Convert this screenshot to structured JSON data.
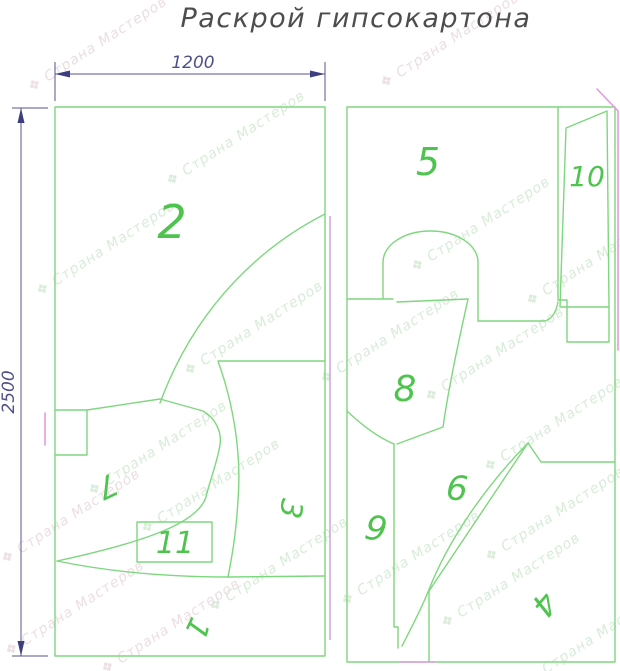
{
  "title": "Раскрой гипсокартона",
  "dimensions": {
    "width": "1200",
    "height": "2500"
  },
  "watermark": {
    "text": "Страна Мастеров",
    "icon": "❖"
  },
  "watermarks": {
    "items": [
      {
        "x": 100,
        "y": 48,
        "tone": "p"
      },
      {
        "x": 452,
        "y": 44,
        "tone": "p"
      },
      {
        "x": 238,
        "y": 142,
        "tone": "g"
      },
      {
        "x": 108,
        "y": 252,
        "tone": "g"
      },
      {
        "x": 483,
        "y": 228,
        "tone": "g"
      },
      {
        "x": 598,
        "y": 262,
        "tone": "g"
      },
      {
        "x": 256,
        "y": 332,
        "tone": "g"
      },
      {
        "x": 392,
        "y": 340,
        "tone": "g"
      },
      {
        "x": 497,
        "y": 358,
        "tone": "g"
      },
      {
        "x": 160,
        "y": 452,
        "tone": "g"
      },
      {
        "x": 213,
        "y": 490,
        "tone": "g"
      },
      {
        "x": 73,
        "y": 520,
        "tone": "p"
      },
      {
        "x": 556,
        "y": 428,
        "tone": "g"
      },
      {
        "x": 557,
        "y": 518,
        "tone": "g"
      },
      {
        "x": 413,
        "y": 562,
        "tone": "g"
      },
      {
        "x": 281,
        "y": 568,
        "tone": "g"
      },
      {
        "x": 77,
        "y": 612,
        "tone": "p"
      },
      {
        "x": 513,
        "y": 584,
        "tone": "g"
      },
      {
        "x": 598,
        "y": 640,
        "tone": "g"
      },
      {
        "x": 173,
        "y": 630,
        "tone": "p"
      }
    ]
  },
  "pieces": [
    {
      "id": "2",
      "label": "2"
    },
    {
      "id": "7",
      "label": "7"
    },
    {
      "id": "3",
      "label": "3"
    },
    {
      "id": "11",
      "label": "11"
    },
    {
      "id": "1",
      "label": "1"
    },
    {
      "id": "5",
      "label": "5"
    },
    {
      "id": "10",
      "label": "10"
    },
    {
      "id": "8",
      "label": "8"
    },
    {
      "id": "9",
      "label": "9"
    },
    {
      "id": "6",
      "label": "6"
    },
    {
      "id": "4",
      "label": "4"
    }
  ],
  "colors": {
    "line_green": "#7ed77e",
    "label_green": "#4ec44e",
    "dimension_blue": "#55558f",
    "magenta": "#e59ae2",
    "title_gray": "#4d4d4d"
  }
}
